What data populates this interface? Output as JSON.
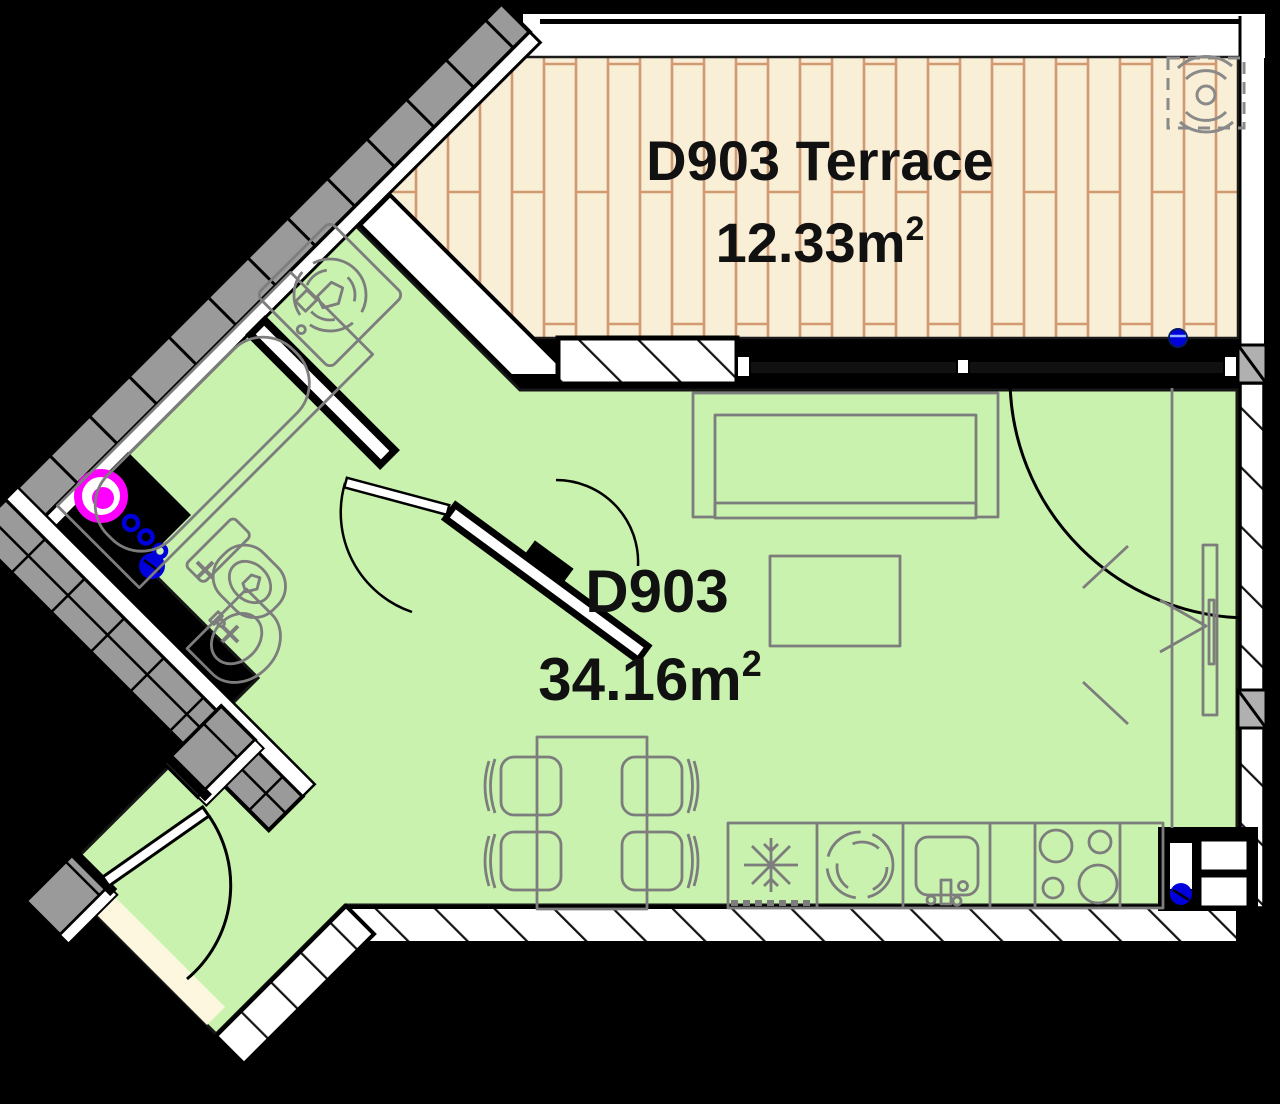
{
  "title": "Apartment D903 floor plan with terrace",
  "rooms": {
    "terrace": {
      "label": "D903 Terrace",
      "area_value": "12.33",
      "area_unit": "m",
      "area_sup": "2"
    },
    "main": {
      "label": "D903",
      "area_value": "34.16",
      "area_unit": "m",
      "area_sup": "2"
    }
  },
  "colors": {
    "background": "#000000",
    "floor_main": "#c9f2ae",
    "floor_terrace_wood": "#f9eed6",
    "wood_joint": "#d29a70",
    "wall_tile_gray": "#9a9a9a",
    "wall_pier_gray": "#b0b0b0",
    "hatch_white": "#ffffff",
    "furniture_gray": "#7d7d7d",
    "plumbing_magenta": "#ff00ff",
    "plumbing_blue": "#0000dd",
    "threshold_cream": "#fdf7e0",
    "text": "#111111"
  },
  "fixtures": {
    "bathroom": [
      "bathtub-icon",
      "toilet-icon",
      "washbasin-icon",
      "washing-machine-icon",
      "water-supply-cross-icon",
      "plumbing-riser-icon"
    ],
    "living": [
      "sofa-icon",
      "coffee-table-icon",
      "dining-table-icon",
      "chair-icon",
      "wardrobe-tv-icon",
      "entrance-arrow-icon"
    ],
    "kitchen": [
      "refrigerator-icon",
      "washer-drum-icon",
      "kitchen-sink-icon",
      "cooktop-icon"
    ],
    "terrace": [
      "ac-unit-icon",
      "drain-point-icon"
    ],
    "doors": [
      "bathroom-door",
      "hall-door",
      "terrace-door",
      "entry-door"
    ]
  }
}
